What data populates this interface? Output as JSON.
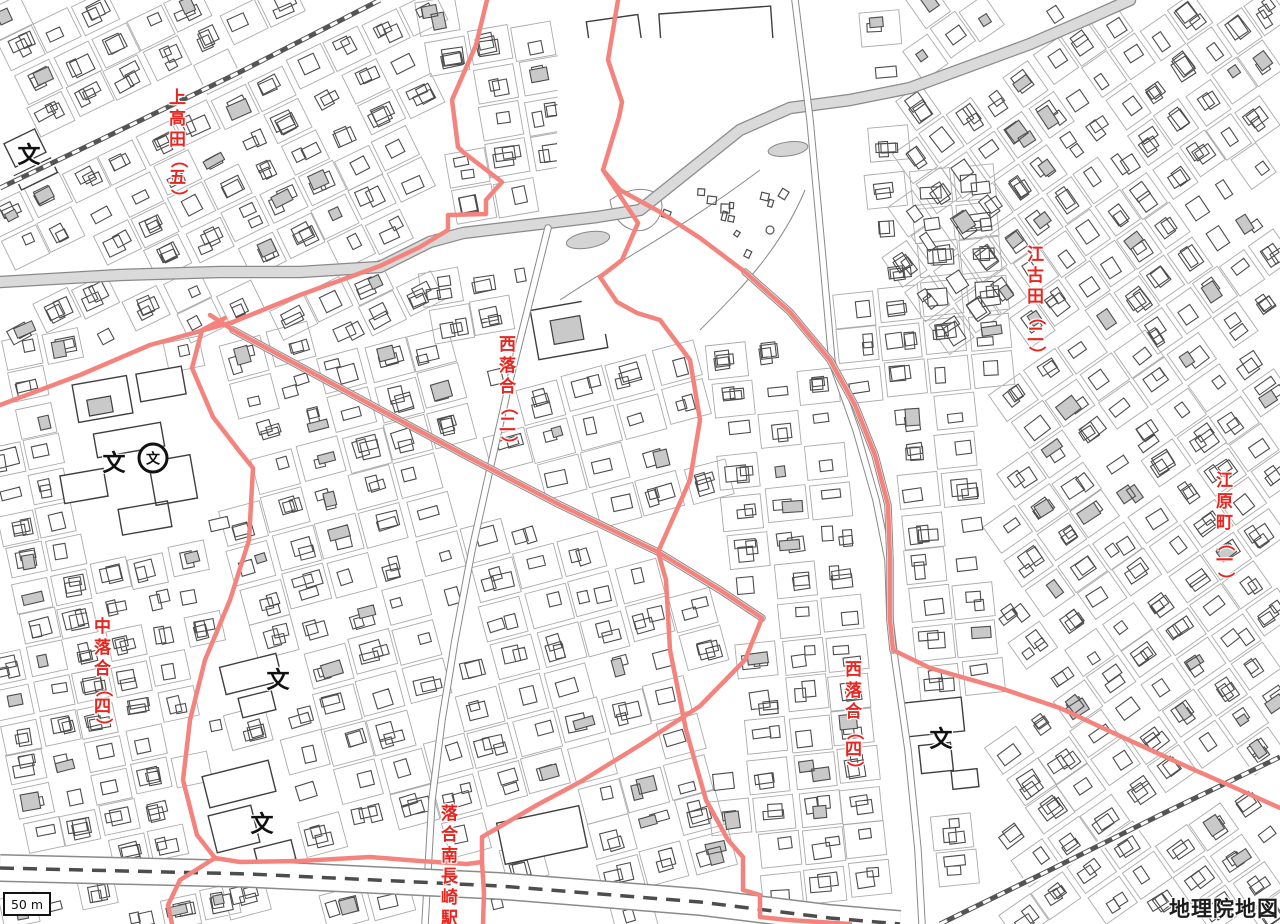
{
  "map": {
    "background": "#ffffff",
    "building_stroke": "#4d4d4d",
    "building_fill": "#ffffff",
    "building_gray_fill": "#c9c9c9",
    "street_line_color": "#ababab",
    "road_casing_color": "#8a8a8a",
    "major_road_fill": "#dadada",
    "boundary_color": "#f4837d",
    "label_color": "#e8251f",
    "railway_color": "#555555",
    "subway_dash_color": "#4d4d4d"
  },
  "labels": [
    {
      "name": "kamitakada-5",
      "text": "上高田（五）",
      "x": 178,
      "y": 88
    },
    {
      "name": "ekoda-2",
      "text": "江古田（二）",
      "x": 1036,
      "y": 245
    },
    {
      "name": "nishiochiai-2",
      "text": "西落合（二）",
      "x": 508,
      "y": 335
    },
    {
      "name": "eharacho-1",
      "text": "江原町（一）",
      "x": 1225,
      "y": 471
    },
    {
      "name": "nakaochiai-4",
      "text": "中落合（四）",
      "x": 103,
      "y": 617
    },
    {
      "name": "nishiochiai-4",
      "text": "西落合（四）",
      "x": 854,
      "y": 660
    },
    {
      "name": "ochiai-minami-nagasaki-station",
      "text": "落合南長崎駅",
      "x": 450,
      "y": 804
    }
  ],
  "symbols": {
    "school_glyph": "文",
    "schools": [
      {
        "x": 29,
        "y": 156
      },
      {
        "x": 114,
        "y": 464
      },
      {
        "x": 278,
        "y": 681
      },
      {
        "x": 262,
        "y": 825
      },
      {
        "x": 941,
        "y": 740
      }
    ],
    "high_school": {
      "x": 153,
      "y": 458
    }
  },
  "boundaries": [
    {
      "name": "ward-boundary-north",
      "points": [
        [
          487,
          0
        ],
        [
          476,
          45
        ],
        [
          452,
          100
        ],
        [
          458,
          147
        ],
        [
          463,
          152
        ],
        [
          502,
          182
        ],
        [
          486,
          200
        ],
        [
          486,
          214
        ],
        [
          448,
          215
        ],
        [
          448,
          230
        ],
        [
          420,
          247
        ],
        [
          380,
          266
        ],
        [
          300,
          295
        ],
        [
          233,
          322
        ],
        [
          150,
          345
        ],
        [
          80,
          375
        ],
        [
          0,
          405
        ]
      ]
    },
    {
      "name": "ward-boundary-west",
      "points": [
        [
          225,
          318
        ],
        [
          202,
          330
        ],
        [
          192,
          368
        ],
        [
          213,
          417
        ],
        [
          240,
          452
        ],
        [
          253,
          468
        ],
        [
          249,
          540
        ],
        [
          230,
          600
        ],
        [
          205,
          660
        ],
        [
          190,
          720
        ],
        [
          183,
          780
        ],
        [
          197,
          835
        ],
        [
          215,
          858
        ],
        [
          180,
          880
        ],
        [
          168,
          905
        ],
        [
          172,
          924
        ]
      ]
    },
    {
      "name": "ward-boundary-central-diagonal",
      "points": [
        [
          210,
          315
        ],
        [
          233,
          330
        ],
        [
          390,
          415
        ],
        [
          470,
          458
        ],
        [
          560,
          505
        ],
        [
          658,
          552
        ],
        [
          720,
          590
        ],
        [
          762,
          618
        ],
        [
          745,
          660
        ],
        [
          700,
          706
        ],
        [
          640,
          745
        ],
        [
          580,
          782
        ],
        [
          537,
          805
        ],
        [
          482,
          837
        ],
        [
          482,
          862
        ],
        [
          467,
          864
        ],
        [
          420,
          861
        ],
        [
          370,
          857
        ],
        [
          300,
          861
        ],
        [
          240,
          862
        ],
        [
          215,
          858
        ]
      ]
    },
    {
      "name": "ward-boundary-station-spur",
      "points": [
        [
          482,
          862
        ],
        [
          484,
          893
        ],
        [
          483,
          924
        ]
      ]
    },
    {
      "name": "ward-boundary-south-center",
      "points": [
        [
          658,
          552
        ],
        [
          666,
          580
        ],
        [
          670,
          650
        ],
        [
          686,
          730
        ],
        [
          706,
          800
        ],
        [
          728,
          840
        ],
        [
          743,
          857
        ],
        [
          743,
          890
        ],
        [
          760,
          895
        ],
        [
          760,
          917
        ],
        [
          788,
          920
        ],
        [
          850,
          924
        ]
      ]
    },
    {
      "name": "ward-boundary-park",
      "points": [
        [
          618,
          0
        ],
        [
          608,
          60
        ],
        [
          622,
          102
        ],
        [
          619,
          117
        ],
        [
          603,
          170
        ],
        [
          638,
          223
        ],
        [
          622,
          260
        ],
        [
          600,
          277
        ],
        [
          617,
          302
        ],
        [
          637,
          313
        ],
        [
          660,
          320
        ],
        [
          690,
          360
        ],
        [
          700,
          420
        ],
        [
          690,
          480
        ],
        [
          670,
          525
        ],
        [
          658,
          552
        ]
      ]
    },
    {
      "name": "ward-boundary-east",
      "points": [
        [
          603,
          170
        ],
        [
          620,
          190
        ],
        [
          660,
          212
        ],
        [
          700,
          238
        ],
        [
          745,
          272
        ],
        [
          790,
          312
        ],
        [
          830,
          360
        ],
        [
          855,
          405
        ],
        [
          875,
          455
        ],
        [
          888,
          505
        ],
        [
          890,
          560
        ],
        [
          890,
          620
        ],
        [
          893,
          650
        ],
        [
          930,
          668
        ],
        [
          1000,
          688
        ],
        [
          1060,
          708
        ],
        [
          1120,
          736
        ],
        [
          1190,
          768
        ],
        [
          1240,
          790
        ],
        [
          1280,
          808
        ]
      ]
    }
  ],
  "railways": [
    {
      "name": "railway-northwest",
      "points": [
        [
          0,
          188
        ],
        [
          100,
          140
        ],
        [
          240,
          72
        ],
        [
          380,
          0
        ]
      ]
    },
    {
      "name": "railway-southeast",
      "points": [
        [
          940,
          924
        ],
        [
          1050,
          870
        ],
        [
          1160,
          815
        ],
        [
          1280,
          757
        ]
      ]
    }
  ],
  "subway": {
    "name": "subway-line-bottom",
    "points": [
      [
        0,
        868
      ],
      [
        250,
        874
      ],
      [
        500,
        886
      ],
      [
        700,
        902
      ],
      [
        830,
        918
      ],
      [
        900,
        924
      ]
    ]
  },
  "river": {
    "name": "gray-band-road",
    "points": [
      [
        0,
        282
      ],
      [
        120,
        275
      ],
      [
        220,
        272
      ],
      [
        300,
        272
      ],
      [
        380,
        267
      ],
      [
        430,
        242
      ],
      [
        463,
        233
      ],
      [
        530,
        225
      ],
      [
        597,
        217
      ],
      [
        640,
        210
      ],
      [
        690,
        170
      ],
      [
        740,
        130
      ],
      [
        790,
        108
      ],
      [
        850,
        100
      ],
      [
        910,
        88
      ],
      [
        970,
        66
      ],
      [
        1030,
        44
      ],
      [
        1090,
        18
      ],
      [
        1130,
        0
      ]
    ]
  },
  "roads": [
    {
      "name": "road-north-south-right",
      "points": [
        [
          795,
          0
        ],
        [
          810,
          120
        ],
        [
          822,
          250
        ],
        [
          832,
          362
        ],
        [
          856,
          430
        ],
        [
          876,
          500
        ],
        [
          888,
          560
        ],
        [
          890,
          620
        ],
        [
          895,
          660
        ],
        [
          908,
          750
        ],
        [
          918,
          850
        ],
        [
          922,
          924
        ]
      ]
    },
    {
      "name": "road-north-south-center",
      "points": [
        [
          548,
          228
        ],
        [
          530,
          300
        ],
        [
          510,
          380
        ],
        [
          492,
          460
        ],
        [
          472,
          550
        ],
        [
          455,
          640
        ],
        [
          442,
          720
        ],
        [
          432,
          800
        ],
        [
          425,
          924
        ]
      ]
    },
    {
      "name": "road-central-diagonal",
      "points": [
        [
          233,
          330
        ],
        [
          390,
          415
        ],
        [
          470,
          458
        ],
        [
          560,
          505
        ],
        [
          658,
          552
        ],
        [
          720,
          590
        ],
        [
          762,
          618
        ]
      ]
    },
    {
      "name": "road-east-curve",
      "points": [
        [
          745,
          272
        ],
        [
          790,
          312
        ],
        [
          830,
          360
        ],
        [
          855,
          405
        ],
        [
          875,
          455
        ],
        [
          888,
          505
        ],
        [
          890,
          560
        ],
        [
          890,
          620
        ],
        [
          893,
          650
        ]
      ]
    }
  ],
  "park": {
    "outline": [
      [
        558,
        38
      ],
      [
        848,
        38
      ],
      [
        852,
        150
      ],
      [
        800,
        332
      ],
      [
        598,
        334
      ],
      [
        556,
        250
      ]
    ],
    "ponds": [
      {
        "cx": 588,
        "cy": 240,
        "rx": 22,
        "ry": 8,
        "angle": -10
      },
      {
        "cx": 788,
        "cy": 149,
        "rx": 20,
        "ry": 7,
        "angle": -8
      }
    ]
  },
  "scalebar": {
    "text": "50 m"
  },
  "attribution": {
    "text": "地理院地図"
  }
}
